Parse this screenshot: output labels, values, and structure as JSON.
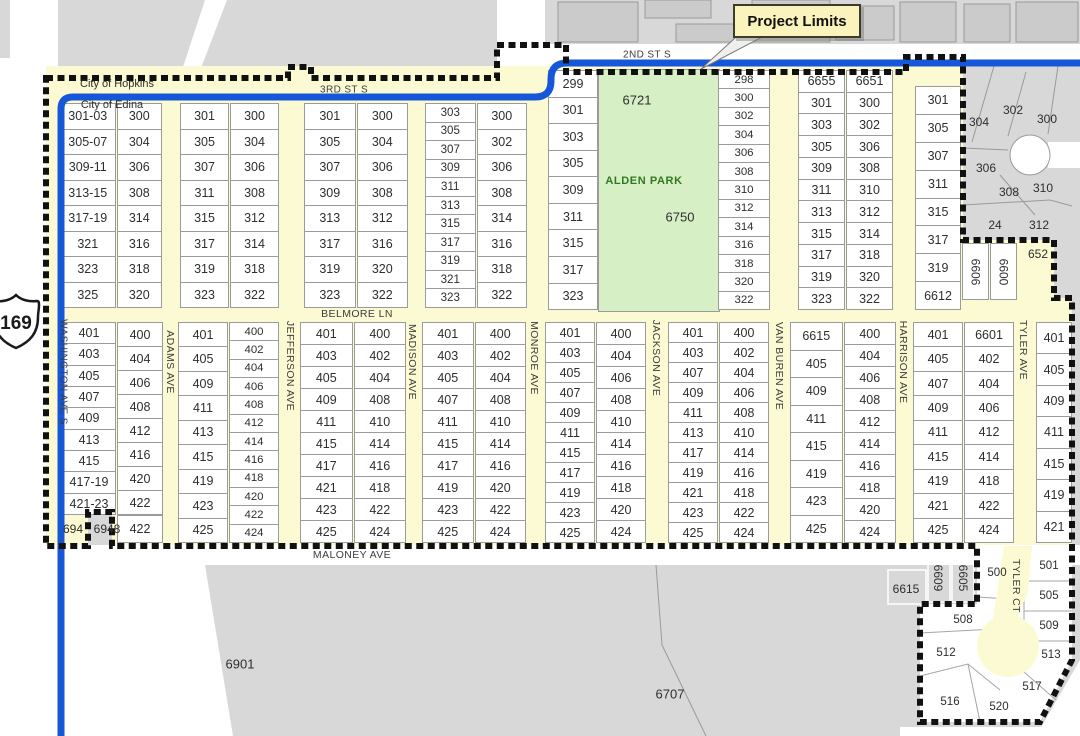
{
  "callout": {
    "text": "Project Limits",
    "x": 733,
    "y": 4,
    "w": 124,
    "h": 30
  },
  "highway_shield": {
    "number": "169"
  },
  "colors": {
    "yellow": "#FBFAD2",
    "park_green": "#D7EFC5",
    "park_text": "#2F7A1F",
    "blue": "#1656D8",
    "gray": "#D8D8D8",
    "building": "#CBCBCB",
    "boundary": "#111111",
    "callout_bg": "#FBF3BC"
  },
  "streets": [
    {
      "name": "2ND ST S",
      "x": 647,
      "y": 55,
      "rot": 0,
      "size": 10
    },
    {
      "name": "3RD ST S",
      "x": 344,
      "y": 90,
      "rot": 0,
      "size": 10
    },
    {
      "name": "BELMORE LN",
      "x": 357,
      "y": 314,
      "rot": 0,
      "size": 10.5
    },
    {
      "name": "MALONEY AVE",
      "x": 352,
      "y": 555,
      "rot": 0,
      "size": 10.5
    },
    {
      "name": "WASHINGTON AVE S",
      "x": 63,
      "y": 372,
      "rot": 90,
      "size": 10
    },
    {
      "name": "ADAMS AVE",
      "x": 170,
      "y": 362,
      "rot": 90,
      "size": 10.5
    },
    {
      "name": "JEFFERSON AVE",
      "x": 290,
      "y": 366,
      "rot": 90,
      "size": 10.5
    },
    {
      "name": "MADISON AVE",
      "x": 412,
      "y": 362,
      "rot": 90,
      "size": 10.5
    },
    {
      "name": "MONROE AVE",
      "x": 534,
      "y": 358,
      "rot": 90,
      "size": 10.5
    },
    {
      "name": "JACKSON AVE",
      "x": 656,
      "y": 358,
      "rot": 90,
      "size": 10.5
    },
    {
      "name": "VAN BUREN AVE",
      "x": 779,
      "y": 366,
      "rot": 90,
      "size": 10.5
    },
    {
      "name": "HARRISON AVE",
      "x": 903,
      "y": 362,
      "rot": 90,
      "size": 10.5
    },
    {
      "name": "TYLER AVE",
      "x": 1023,
      "y": 350,
      "rot": 90,
      "size": 10.5
    },
    {
      "name": "TYLER CT",
      "x": 1016,
      "y": 586,
      "rot": 90,
      "size": 10.5
    }
  ],
  "park": {
    "name": "ALDEN PARK",
    "x": 598,
    "y": 69,
    "w": 120,
    "h": 241
  },
  "blocks": [
    {
      "id": "n1",
      "x": 60,
      "y": 103,
      "w": 102,
      "h": 205,
      "colw": [
        0.55,
        0.45
      ],
      "cols": [
        [
          "301-03",
          "305-07",
          "309-11",
          "313-15",
          "317-19",
          "321",
          "323",
          "325"
        ],
        [
          "300",
          "304",
          "306",
          "308",
          "314",
          "316",
          "318",
          "320"
        ]
      ]
    },
    {
      "id": "n2",
      "x": 180,
      "y": 103,
      "w": 99,
      "h": 205,
      "cols": [
        [
          "301",
          "305",
          "307",
          "311",
          "315",
          "317",
          "319",
          "323"
        ],
        [
          "300",
          "304",
          "306",
          "308",
          "312",
          "314",
          "318",
          "322"
        ]
      ]
    },
    {
      "id": "n3",
      "x": 304,
      "y": 103,
      "w": 104,
      "h": 205,
      "cols": [
        [
          "301",
          "305",
          "307",
          "309",
          "313",
          "317",
          "319",
          "323"
        ],
        [
          "300",
          "304",
          "306",
          "308",
          "312",
          "316",
          "320",
          "322"
        ]
      ]
    },
    {
      "id": "n4",
      "x": 425,
      "y": 103,
      "w": 102,
      "h": 205,
      "cols": [
        [
          "303",
          "305",
          "307",
          "309",
          "311",
          "313",
          "315",
          "317",
          "319",
          "321",
          "323"
        ],
        [
          "300",
          "302",
          "306",
          "308",
          "314",
          "316",
          "318",
          "322"
        ]
      ]
    },
    {
      "id": "n5-west",
      "x": 548,
      "y": 70,
      "w": 50,
      "h": 240,
      "cols": [
        [
          "299",
          "301",
          "303",
          "305",
          "309",
          "311",
          "315",
          "317",
          "323"
        ]
      ]
    },
    {
      "id": "n5-east",
      "x": 718,
      "y": 70,
      "w": 52,
      "h": 240,
      "cols": [
        [
          "298",
          "300",
          "302",
          "304",
          "306",
          "308",
          "310",
          "312",
          "314",
          "316",
          "318",
          "320",
          "322"
        ]
      ]
    },
    {
      "id": "n6",
      "x": 798,
      "y": 70,
      "w": 95,
      "h": 240,
      "cols": [
        [
          "6655",
          "301",
          "303",
          "305",
          "309",
          "311",
          "313",
          "315",
          "317",
          "319",
          "323"
        ],
        [
          "6651",
          "300",
          "302",
          "306",
          "308",
          "310",
          "312",
          "314",
          "318",
          "320",
          "322"
        ]
      ]
    },
    {
      "id": "n7",
      "x": 915,
      "y": 86,
      "w": 46,
      "h": 224,
      "cols": [
        [
          "301",
          "305",
          "307",
          "311",
          "315",
          "317",
          "319",
          "6612"
        ]
      ]
    },
    {
      "id": "s1",
      "x": 62,
      "y": 322,
      "w": 101,
      "h": 193,
      "colw": [
        0.54,
        0.46
      ],
      "cols": [
        [
          "401",
          "403",
          "405",
          "407",
          "409",
          "413",
          "415",
          "417-19",
          "421-23"
        ],
        [
          "400",
          "404",
          "406",
          "408",
          "412",
          "416",
          "420",
          "422"
        ]
      ]
    },
    {
      "id": "s1b",
      "x": 117,
      "y": 515,
      "w": 46,
      "h": 28,
      "cols": [
        [
          "422"
        ]
      ]
    },
    {
      "id": "s2",
      "x": 178,
      "y": 322,
      "w": 101,
      "h": 221,
      "cols": [
        [
          "401",
          "405",
          "409",
          "411",
          "413",
          "415",
          "419",
          "423",
          "425"
        ],
        [
          "400",
          "402",
          "404",
          "406",
          "408",
          "412",
          "414",
          "416",
          "418",
          "420",
          "422",
          "424"
        ]
      ]
    },
    {
      "id": "s3",
      "x": 300,
      "y": 322,
      "w": 106,
      "h": 221,
      "cols": [
        [
          "401",
          "403",
          "405",
          "409",
          "411",
          "415",
          "417",
          "421",
          "423",
          "425"
        ],
        [
          "400",
          "402",
          "404",
          "408",
          "410",
          "414",
          "416",
          "418",
          "422",
          "424"
        ]
      ]
    },
    {
      "id": "s4",
      "x": 422,
      "y": 322,
      "w": 104,
      "h": 221,
      "cols": [
        [
          "401",
          "403",
          "405",
          "407",
          "411",
          "415",
          "417",
          "419",
          "423",
          "425"
        ],
        [
          "400",
          "402",
          "404",
          "408",
          "410",
          "414",
          "416",
          "420",
          "422",
          "424"
        ]
      ]
    },
    {
      "id": "s5",
      "x": 545,
      "y": 322,
      "w": 101,
      "h": 221,
      "cols": [
        [
          "401",
          "403",
          "405",
          "407",
          "409",
          "411",
          "415",
          "417",
          "419",
          "423",
          "425"
        ],
        [
          "400",
          "404",
          "406",
          "408",
          "410",
          "414",
          "416",
          "418",
          "420",
          "424"
        ]
      ]
    },
    {
      "id": "s6",
      "x": 668,
      "y": 322,
      "w": 101,
      "h": 221,
      "cols": [
        [
          "401",
          "403",
          "407",
          "409",
          "411",
          "413",
          "417",
          "419",
          "421",
          "423",
          "425"
        ],
        [
          "400",
          "402",
          "404",
          "406",
          "408",
          "410",
          "414",
          "416",
          "418",
          "422",
          "424"
        ]
      ]
    },
    {
      "id": "s7",
      "x": 790,
      "y": 322,
      "w": 106,
      "h": 221,
      "cols": [
        [
          "6615",
          "405",
          "409",
          "411",
          "415",
          "419",
          "423",
          "425"
        ],
        [
          "400",
          "404",
          "406",
          "408",
          "412",
          "414",
          "416",
          "418",
          "420",
          "424"
        ]
      ]
    },
    {
      "id": "s8",
      "x": 913,
      "y": 322,
      "w": 101,
      "h": 221,
      "cols": [
        [
          "401",
          "405",
          "407",
          "409",
          "411",
          "415",
          "419",
          "421",
          "425"
        ],
        [
          "6601",
          "402",
          "404",
          "406",
          "412",
          "414",
          "418",
          "422",
          "424"
        ]
      ]
    },
    {
      "id": "s9",
      "x": 1036,
      "y": 322,
      "w": 36,
      "h": 221,
      "cols": [
        [
          "401",
          "405",
          "409",
          "411",
          "415",
          "419",
          "421"
        ]
      ]
    }
  ],
  "misc_parcels": [
    {
      "label": "6606",
      "x": 962,
      "y": 243,
      "w": 27,
      "h": 57,
      "rot": 90
    },
    {
      "label": "6600",
      "x": 990,
      "y": 243,
      "w": 27,
      "h": 57,
      "rot": 90
    }
  ],
  "labels": [
    {
      "t": "City of Hopkins",
      "x": 117,
      "y": 84,
      "s": 11
    },
    {
      "t": "City of Edina",
      "x": 112,
      "y": 105,
      "s": 11
    },
    {
      "t": "ALDEN PARK",
      "x": 644,
      "y": 181,
      "s": 11,
      "c": "#2F7A1F",
      "b": 1
    },
    {
      "t": "6721",
      "x": 637,
      "y": 100,
      "s": 13
    },
    {
      "t": "6750",
      "x": 680,
      "y": 217,
      "s": 13
    },
    {
      "t": "6901",
      "x": 240,
      "y": 664,
      "s": 13
    },
    {
      "t": "6707",
      "x": 670,
      "y": 694,
      "s": 13
    },
    {
      "t": "652",
      "x": 1038,
      "y": 254,
      "s": 12
    },
    {
      "t": "694",
      "x": 73,
      "y": 529,
      "s": 12
    },
    {
      "t": "6948",
      "x": 107,
      "y": 529,
      "s": 12
    },
    {
      "t": "6615",
      "x": 906,
      "y": 589,
      "s": 12
    },
    {
      "t": "6609",
      "x": 938,
      "y": 578,
      "s": 12,
      "r": 90
    },
    {
      "t": "6605",
      "x": 963,
      "y": 578,
      "s": 12,
      "r": 90
    },
    {
      "t": "304",
      "x": 979,
      "y": 122,
      "s": 12
    },
    {
      "t": "302",
      "x": 1013,
      "y": 110,
      "s": 12
    },
    {
      "t": "300",
      "x": 1047,
      "y": 119,
      "s": 12
    },
    {
      "t": "306",
      "x": 986,
      "y": 168,
      "s": 12
    },
    {
      "t": "308",
      "x": 1009,
      "y": 192,
      "s": 12
    },
    {
      "t": "310",
      "x": 1043,
      "y": 188,
      "s": 12
    },
    {
      "t": "24",
      "x": 995,
      "y": 225,
      "s": 12
    },
    {
      "t": "312",
      "x": 1039,
      "y": 225,
      "s": 12
    },
    {
      "t": "500",
      "x": 997,
      "y": 573,
      "s": 11.5
    },
    {
      "t": "501",
      "x": 1049,
      "y": 566,
      "s": 11.5
    },
    {
      "t": "505",
      "x": 1049,
      "y": 596,
      "s": 11.5
    },
    {
      "t": "509",
      "x": 1049,
      "y": 626,
      "s": 11.5
    },
    {
      "t": "513",
      "x": 1051,
      "y": 655,
      "s": 11.5
    },
    {
      "t": "517",
      "x": 1032,
      "y": 687,
      "s": 11.5
    },
    {
      "t": "520",
      "x": 999,
      "y": 707,
      "s": 11.5
    },
    {
      "t": "516",
      "x": 950,
      "y": 702,
      "s": 11.5
    },
    {
      "t": "512",
      "x": 946,
      "y": 653,
      "s": 11.5
    },
    {
      "t": "508",
      "x": 963,
      "y": 620,
      "s": 11.5
    }
  ]
}
